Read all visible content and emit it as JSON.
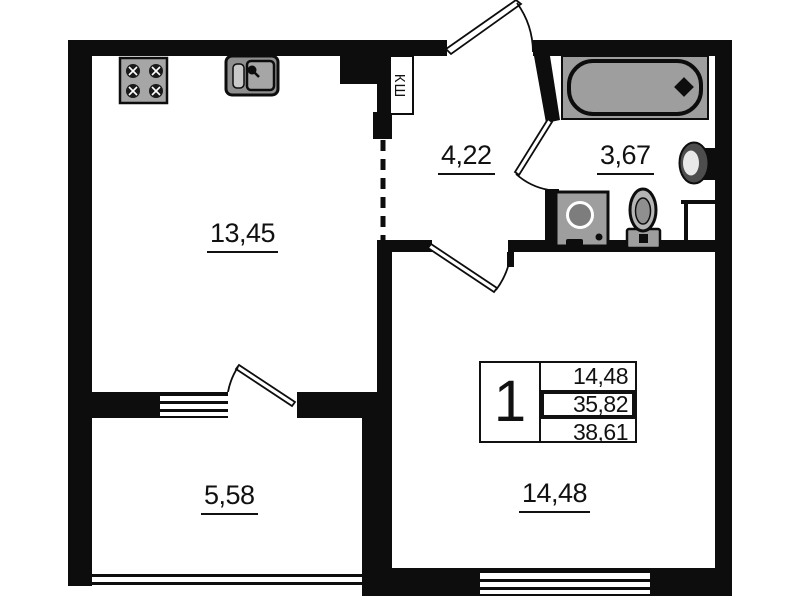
{
  "floor_plan": {
    "rooms": [
      {
        "id": "kitchen-living",
        "area": "13,45"
      },
      {
        "id": "hallway",
        "area": "4,22"
      },
      {
        "id": "bathroom",
        "area": "3,67"
      },
      {
        "id": "balcony",
        "area": "5,58"
      },
      {
        "id": "bedroom",
        "area": "14,48"
      }
    ],
    "closet_label": "КШ",
    "summary_table": {
      "flat_number": "1",
      "rows": [
        "14,48",
        "35,82",
        "38,61"
      ]
    },
    "icons": [
      "stove-icon",
      "kitchen-sink-icon",
      "bathtub-icon",
      "washbasin-icon",
      "toilet-icon",
      "washing-machine-icon"
    ],
    "colors": {
      "wall": "#0d0d0d",
      "fixture_fill": "#9e9e9e",
      "background": "#ffffff"
    }
  }
}
